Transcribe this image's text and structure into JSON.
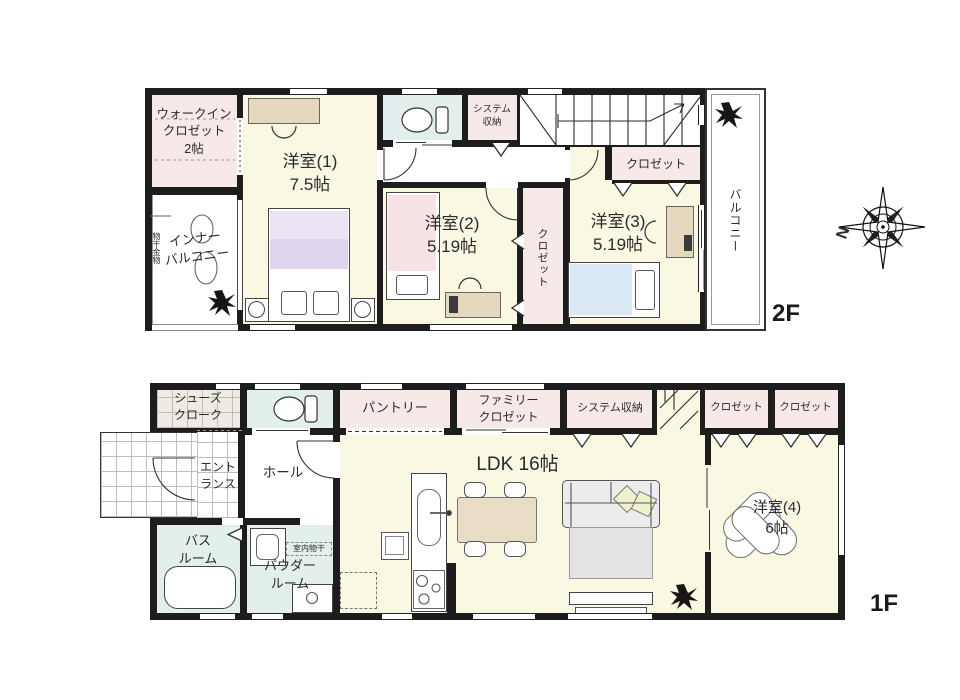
{
  "colors": {
    "wall": "#1d1d1d",
    "room_cream": "#faf7e3",
    "closet_pink": "#f8e9e9",
    "wet_area_blue": "#e2efec",
    "tile_gray": "#edebe4",
    "furniture_beige": "#e6d8be",
    "bed_purple_light": "#eae4f3",
    "bed_purple": "#ded6ee",
    "bed_pink": "#f7e2e5",
    "bed_blue": "#dbe9f6",
    "sofa_gray": "#ececec",
    "rug_gray": "#e3e3e3",
    "cushion_green": "#eff0cc"
  },
  "f2": {
    "badge": "2F",
    "labels": {
      "wic": "ウォークイン\nクロゼット\n2帖",
      "inner_balcony": "インナー\nバルコニー",
      "monohoshi": "物干金物",
      "room1": "洋室(1)\n7.5帖",
      "room2": "洋室(2)\n5.19帖",
      "room3": "洋室(3)\n5.19帖",
      "system_storage": "システム\n収納",
      "closet_room3": "クロゼット",
      "closet_vertical": "クロゼット",
      "balcony": "バルコニー"
    }
  },
  "f1": {
    "badge": "1F",
    "labels": {
      "shoes_cloak": "シューズ\nクローク",
      "entrance": "エント\nランス",
      "hall": "ホール",
      "bathroom": "バス\nルーム",
      "powder_room": "パウダー\nルーム",
      "indoor_drying": "室内物干",
      "pantry": "パントリー",
      "family_closet": "ファミリー\nクロゼット",
      "system_storage": "システム収納",
      "closet_a": "クロゼット",
      "closet_b": "クロゼット",
      "ldk": "LDK 16帖",
      "room4": "洋室(4)\n6帖"
    }
  },
  "compass": {
    "north": "N"
  }
}
